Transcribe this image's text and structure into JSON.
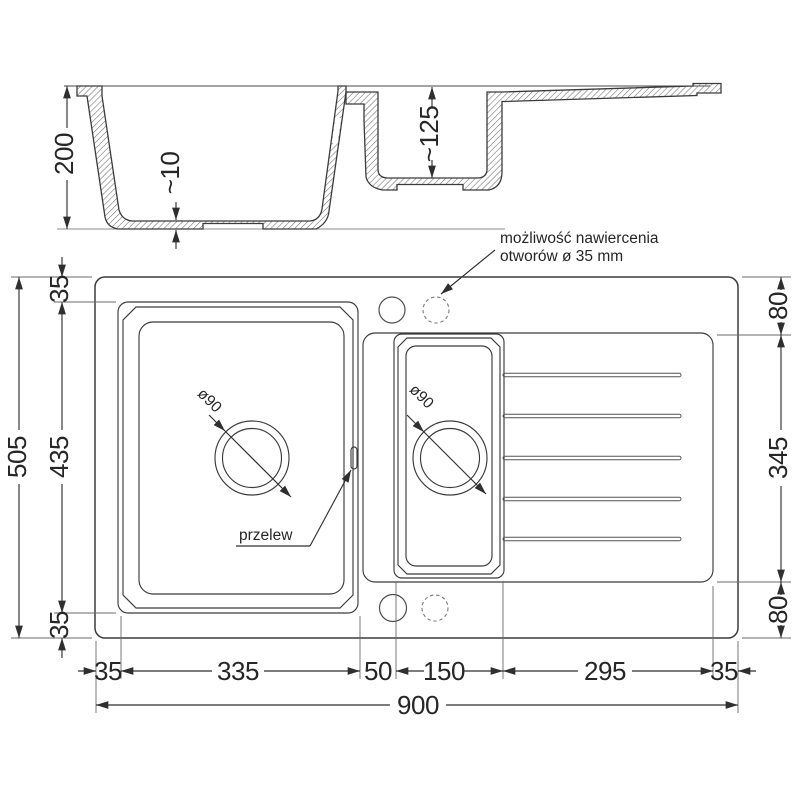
{
  "section": {
    "depth_total": "200",
    "bottom_thickness": "~10",
    "small_bowl_depth": "~125"
  },
  "note": {
    "line1": "możliwość nawiercenia",
    "line2": "otworów ø 35 mm"
  },
  "plan": {
    "overflow_label": "przelew",
    "main_drain_label": "ø90",
    "small_drain_label": "ø90"
  },
  "dims": {
    "left_total": "505",
    "left_chain": [
      "35",
      "435",
      "35"
    ],
    "right_chain": [
      "80",
      "345",
      "80"
    ],
    "bottom_chain": [
      "35",
      "335",
      "50",
      "150",
      "295",
      "35"
    ],
    "bottom_total": "900"
  }
}
